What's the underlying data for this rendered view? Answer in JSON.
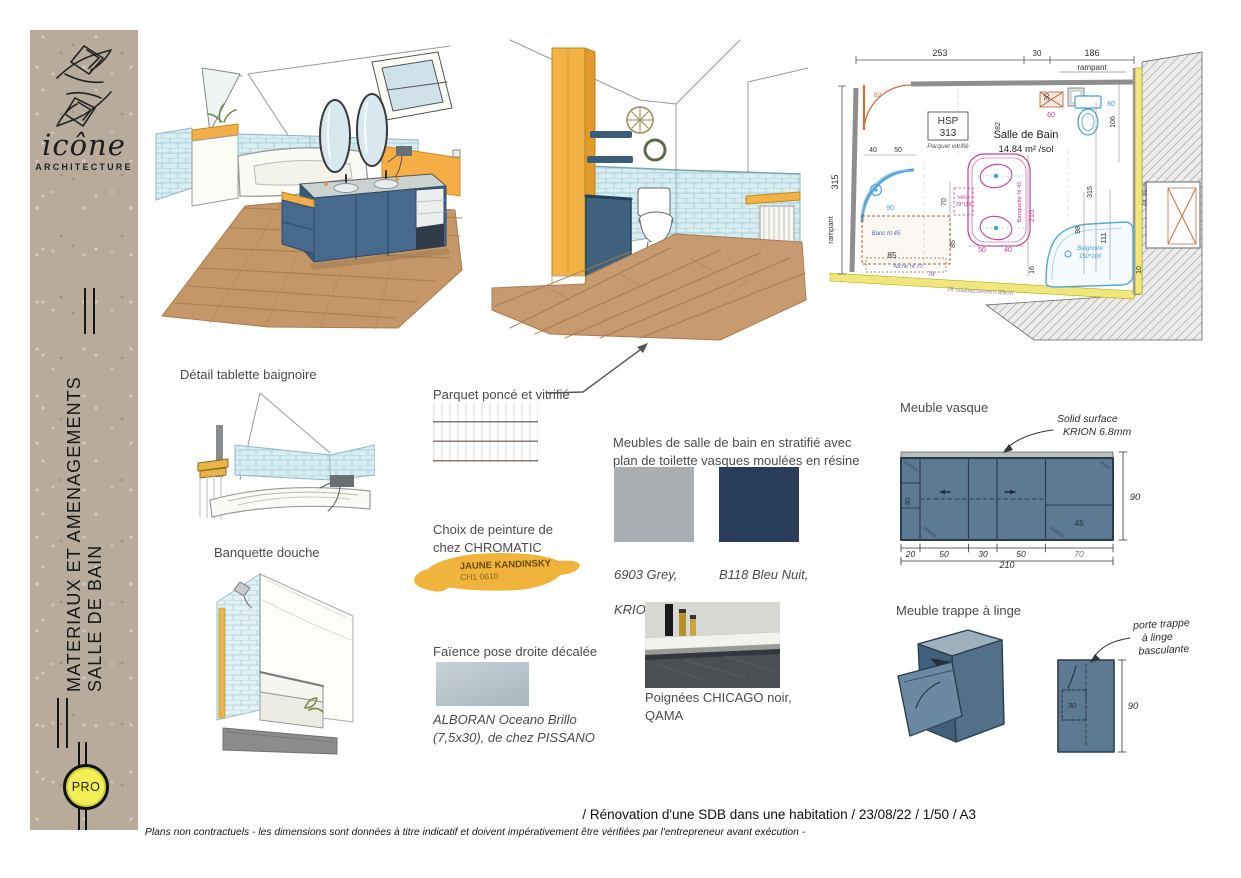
{
  "sidebar": {
    "logo_name": "icône",
    "logo_subtitle": "ARCHITECTURE",
    "title_line1": "MATERIAUX ET AMENAGEMENTS",
    "title_line2": "SALLE DE BAIN",
    "badge": "PRO"
  },
  "labels": {
    "detail_tablette": "Détail tablette baignoire",
    "banquette": "Banquette douche",
    "parquet": "Parquet poncé et vitrifié",
    "peinture": "Choix de peinture de\nchez CHROMATIC",
    "peinture_name": "JAUNE KANDINSKY",
    "peinture_code": "CH1 0610",
    "faience": "Faïence pose droite décalée",
    "faience_ref": "ALBORAN Oceano Brillo\n(7,5x30), de chez PISSANO",
    "meubles": "Meubles de salle de bain en stratifié avec plan de toilette vasques moulées en résine",
    "swatch1_line1": "6903 Grey,",
    "swatch1_line2": "KRION",
    "swatch2_line1": "B118 Bleu Nuit,",
    "swatch2_line2": "POLYREY",
    "poignees": "Poignées CHICAGO noir,\nQAMA",
    "meuble_vasque": "Meuble vasque",
    "trappe": "Meuble trappe à linge",
    "vasque_note1": "Solid surface",
    "vasque_note2": "KRION 6.8mm",
    "trappe_note1": "porte trappe",
    "trappe_note2": "à linge",
    "trappe_note3": "basculante"
  },
  "vasque_dims": {
    "d20": "20",
    "d50a": "50",
    "d30": "30",
    "d50b": "50",
    "d70": "70",
    "total": "210",
    "height": "90",
    "inner30": "30",
    "inner45": "45"
  },
  "trappe_dims": {
    "height": "90",
    "inner": "30"
  },
  "plan": {
    "d253": "253",
    "d30top": "30",
    "d186": "186",
    "rampant_top": "rampant",
    "rampant_left": "rampant",
    "d315left": "315",
    "d82door": "82",
    "hsp": "HSP",
    "hsp_v": "313",
    "hsp_note": "Parquet vitrifié",
    "room": "Salle de Bain",
    "area": "14.84 m² /sol",
    "d40": "40",
    "d50": "50",
    "d90": "90",
    "banc": "Banc ht 45",
    "d85": "85",
    "d85v": "85",
    "niche": "Niche ht 70",
    "d78": "78",
    "velux1": "Velux",
    "velux2": "78*118",
    "d70": "70",
    "banquette": "Banquette ht 45",
    "d210": "210",
    "d50b": "50",
    "d40b": "40",
    "d60": "60",
    "d80": "80",
    "d30r": "30",
    "d82r": "82",
    "d106": "106",
    "d98": "98",
    "d315r": "315",
    "d111": "111",
    "baignoire1": "Baignoire",
    "baignoire2": "150*100",
    "d16": "16",
    "d10": "10",
    "soubassement": "78 soubassement 85cm",
    "alt": "Alt. 83cm"
  },
  "footer": {
    "project": "/ Rénovation d'une SDB dans une habitation / 23/08/22 / 1/50 / A3",
    "disclaimer": "Plans non contractuels - les dimensions sont données à titre indicatif et doivent impérativement être vérifiées par l'entrepreneur avant exécution -"
  },
  "colors": {
    "kraft": "#b8ab9c",
    "paint_yellow": "#f0b33c",
    "navy_polyrey": "#2a3e5c",
    "grey_krion": "#a9aeb3",
    "tile_alboran": "#b3c1ca",
    "cabinet_blue": "#5d7a93",
    "accent_orange": "#f2b246",
    "plan_wall_yellow": "#f0e77c",
    "plan_blue": "#55a8d8",
    "plan_pink": "#c93d97",
    "plan_orange": "#cf6f35"
  }
}
